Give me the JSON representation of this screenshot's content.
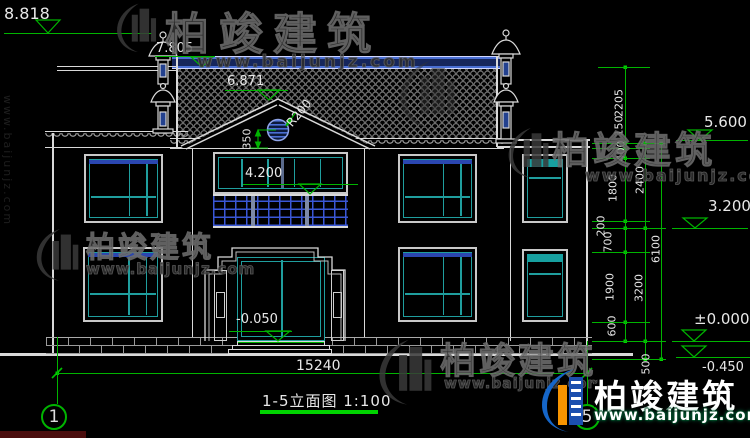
{
  "title": {
    "text": "1-5立面图 1:100"
  },
  "grid": {
    "left": "1",
    "right": "5"
  },
  "dims": {
    "overall_width": "15240",
    "inner_chain": [
      "2205",
      "150",
      "400",
      "1800",
      "200",
      "700",
      "1900",
      "600"
    ],
    "middle_chain": [
      "2400",
      "3200",
      "500"
    ],
    "outer_chain": [
      "6100"
    ]
  },
  "levels": {
    "finial_top": "8.818",
    "ridge": "7.805",
    "gable_peak": "6.871",
    "eave": "5.600",
    "balcony": "4.200",
    "second_floor": "3.200",
    "first_floor": "±0.000",
    "entrance": "-0.050",
    "ground": "-0.450"
  },
  "annotations": {
    "round_window_radius": "R200",
    "round_window_offset": "350"
  },
  "watermark": {
    "brand": "柏竣建筑",
    "url": "www.baijunjz.com"
  },
  "logo": {
    "brand": "柏竣建筑",
    "url": "www.baijunjz.com"
  },
  "colors": {
    "dimension_green": "#00b400",
    "frame_teal": "#1f9e9e",
    "accent_blue": "#2a46b0",
    "ridge_blue": "#16265c",
    "line_white": "#d9d9d9"
  }
}
